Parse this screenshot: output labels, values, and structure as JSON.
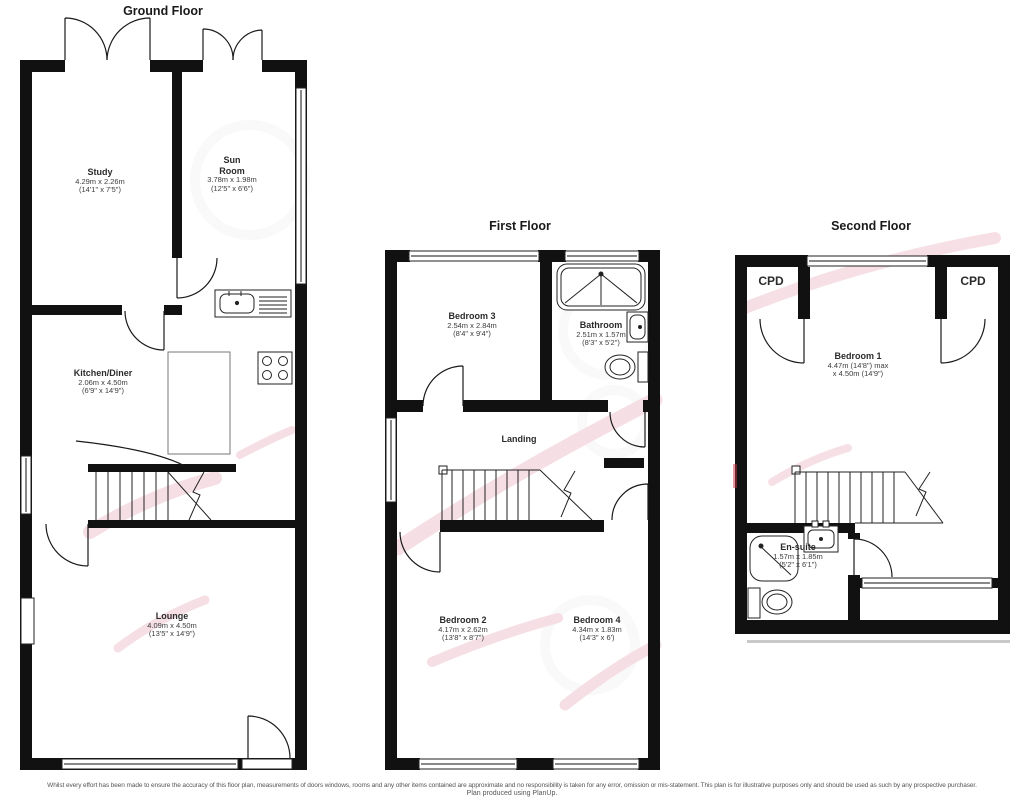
{
  "floors": {
    "ground": {
      "title": "Ground Floor",
      "rooms": {
        "study": {
          "name": "Study",
          "metric": "4.29m x 2.26m",
          "imperial": "(14'1\" x 7'5\")"
        },
        "sun_room": {
          "name": "Sun Room",
          "metric": "3.78m x 1.98m",
          "imperial": "(12'5\" x 6'6\")"
        },
        "kitchen": {
          "name": "Kitchen/Diner",
          "metric": "2.06m x 4.50m",
          "imperial": "(6'9\" x 14'9\")"
        },
        "lounge": {
          "name": "Lounge",
          "metric": "4.09m x 4.50m",
          "imperial": "(13'5\" x 14'9\")"
        }
      }
    },
    "first": {
      "title": "First Floor",
      "rooms": {
        "bedroom3": {
          "name": "Bedroom 3",
          "metric": "2.54m x 2.84m",
          "imperial": "(8'4\" x 9'4\")"
        },
        "bathroom": {
          "name": "Bathroom",
          "metric": "2.51m x 1.57m",
          "imperial": "(8'3\" x 5'2\")"
        },
        "landing": {
          "name": "Landing"
        },
        "bedroom2": {
          "name": "Bedroom 2",
          "metric": "4.17m x 2.62m",
          "imperial": "(13'8\" x 8'7\")"
        },
        "bedroom4": {
          "name": "Bedroom 4",
          "metric": "4.34m x 1.83m",
          "imperial": "(14'3\" x 6')"
        }
      }
    },
    "second": {
      "title": "Second Floor",
      "rooms": {
        "cpd_left": {
          "name": "CPD"
        },
        "cpd_right": {
          "name": "CPD"
        },
        "bedroom1": {
          "name": "Bedroom 1",
          "metric": "4.47m (14'8\") max",
          "imperial": "x 4.50m (14'9\")"
        },
        "ensuite": {
          "name": "En-suite",
          "metric": "1.57m x 1.85m",
          "imperial": "(5'2\" x 6'1\")"
        }
      }
    }
  },
  "footer": {
    "line1": "Whilst every effort has been made to ensure the accuracy of this floor plan, measurements of doors windows, rooms and any other items contained are approximate and no responsibility is taken for any error, omission or mis-statement. This plan is for illustrative purposes only and should be used as such by any prospective purchaser.",
    "line2": "Plan produced using PlanUp."
  }
}
